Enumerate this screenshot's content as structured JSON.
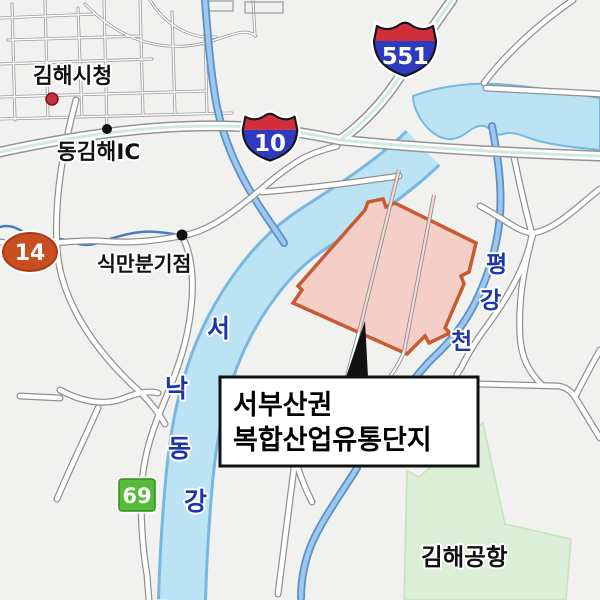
{
  "labels": {
    "city_hall": "김해시청",
    "east_gimhae_ic": "동김해IC",
    "sikman_junction": "식만분기점",
    "airport": "김해공항",
    "river_west_nakdong": {
      "name": "서낙동강",
      "chars": [
        "서",
        "낙",
        "동",
        "강"
      ]
    },
    "stream_pyeonggang": {
      "name": "평강천",
      "chars": [
        "평",
        "강",
        "천"
      ]
    }
  },
  "callout": {
    "line1": "서부산권",
    "line2": "복합산업유통단지"
  },
  "route_shields": {
    "expressway_551": "551",
    "expressway_10": "10",
    "national_route_14": "14",
    "local_route_69": "69"
  },
  "colors": {
    "highlight_fill": "#f5cfc7",
    "highlight_border": "#c75b31",
    "river_fill": "#bce3f3",
    "river_edge": "#78b7e2",
    "stream_fill": "#9cc8ee",
    "stream_edge": "#5b90c8",
    "thin_stream": "#4a7cc4",
    "expressway_accent": "#cfeae3",
    "airport_fill": "#daefd5",
    "airport_edge": "#c6e3be",
    "shield_red": "#d12e3a",
    "shield_blue": "#2e3bbf",
    "national_route_color": "#c94e22",
    "local_route_color": "#57bb3a",
    "river_label_color": "#1c35aa",
    "marker_red": "#c4303c"
  }
}
